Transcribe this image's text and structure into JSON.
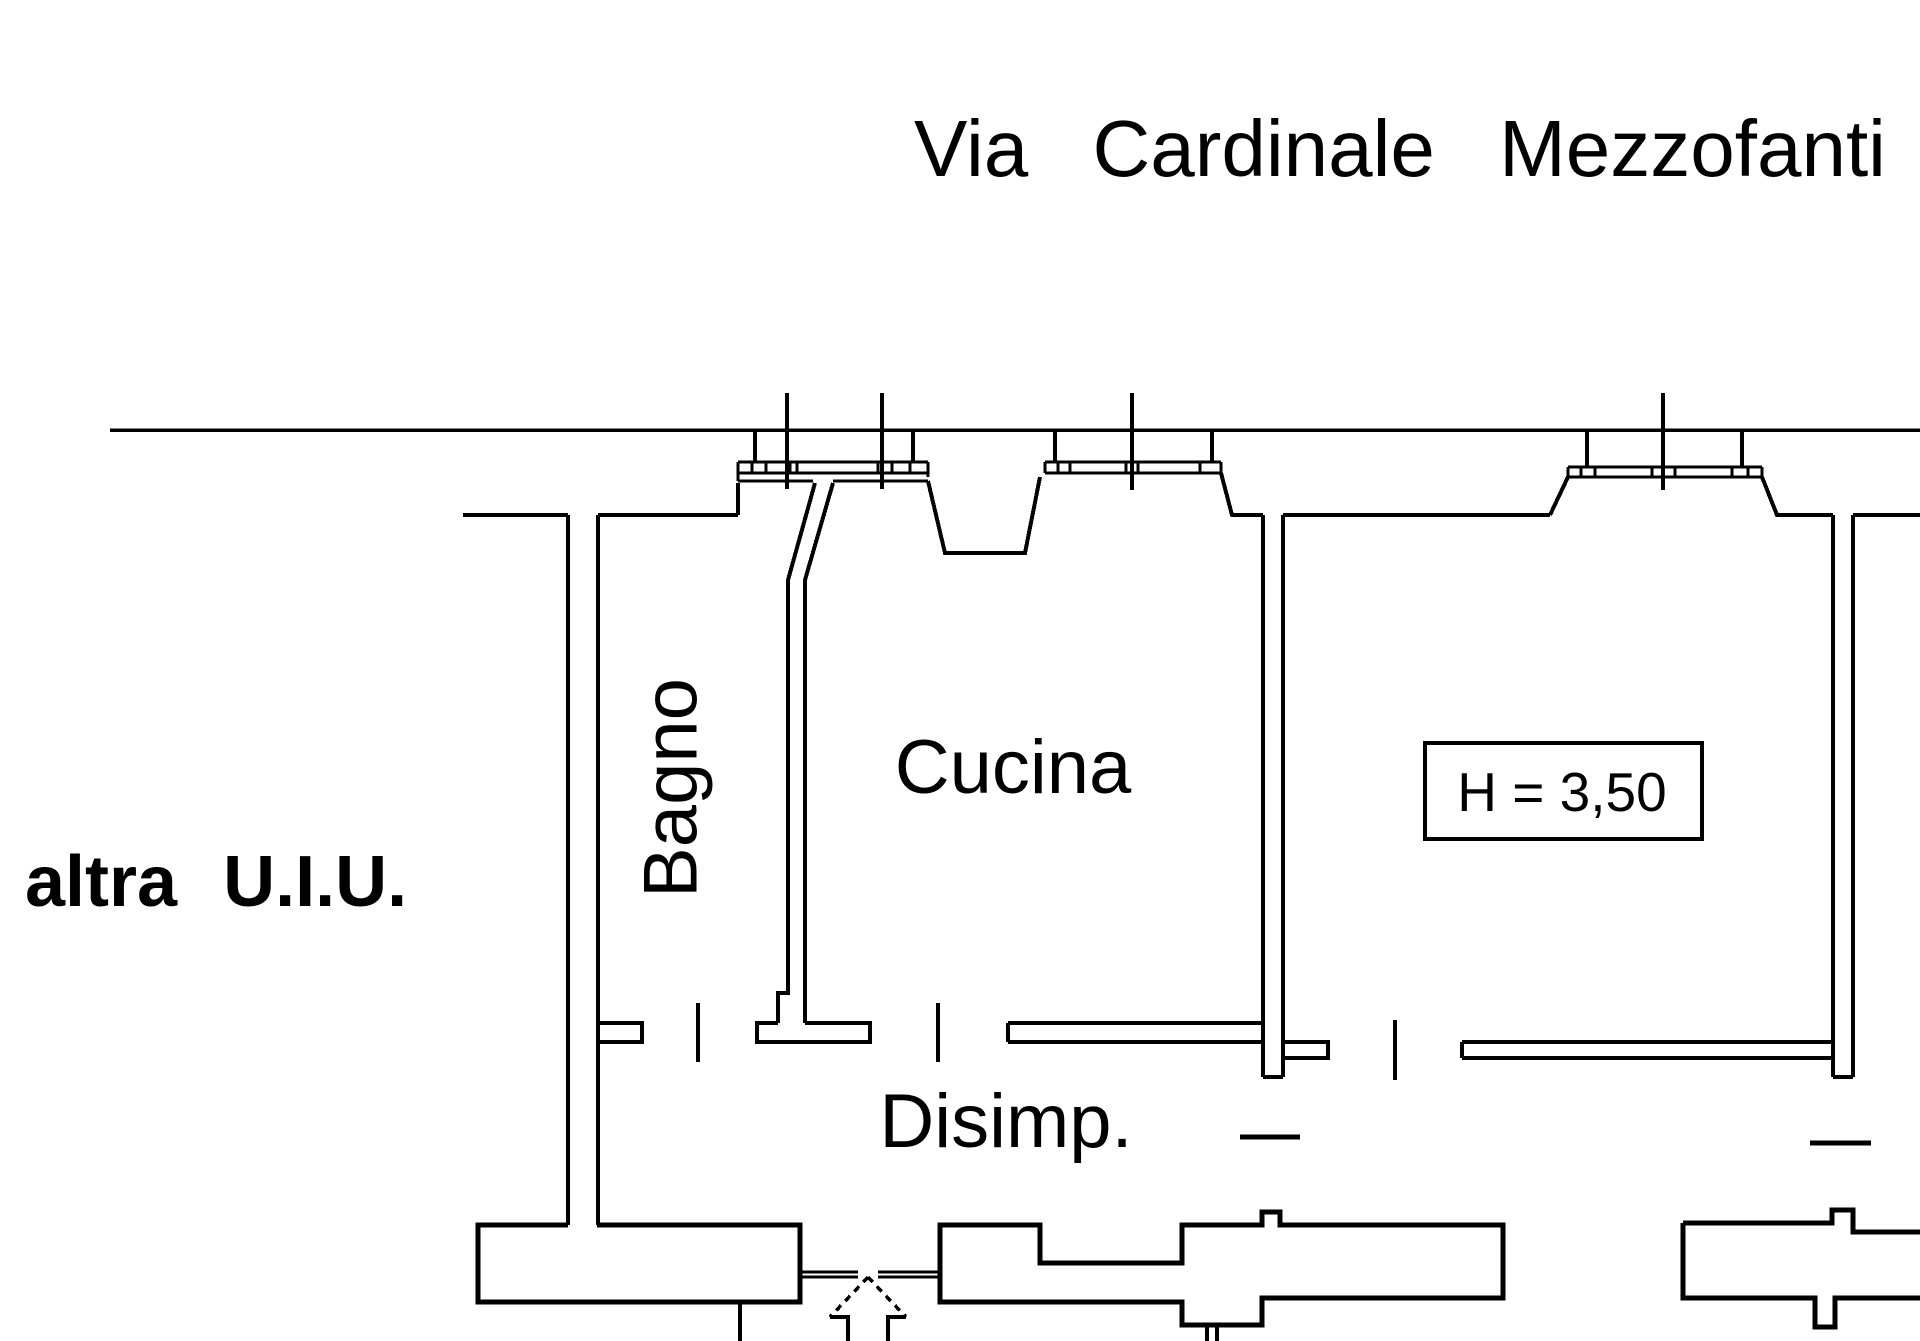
{
  "palette": {
    "background": "#ffffff",
    "line": "#000000"
  },
  "street": {
    "name": "Via Cardinale Mezzofanti"
  },
  "rooms": {
    "bagno": {
      "label": "Bagno"
    },
    "cucina": {
      "label": "Cucina"
    },
    "disimpegno": {
      "label": "Disimp."
    },
    "adjacent_unit": {
      "label": "altra U.I.U."
    }
  },
  "annotations": {
    "ceiling_height": {
      "label": "H = 3,50"
    }
  },
  "icons": {
    "entrance_arrow": "block-arrow-up-dashed-head"
  }
}
